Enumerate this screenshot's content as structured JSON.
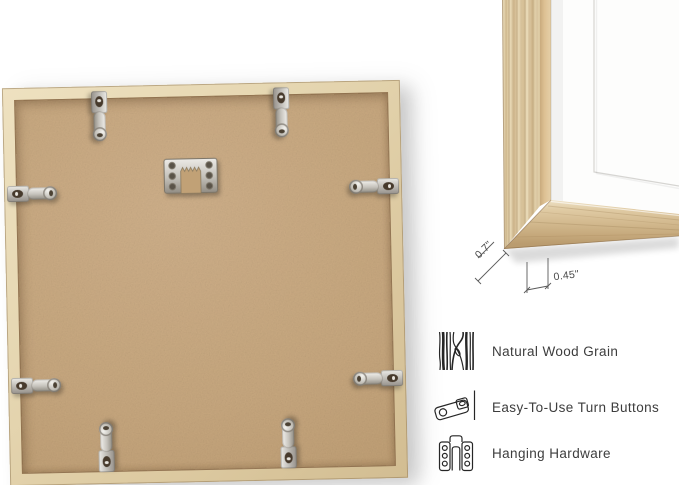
{
  "scene": {
    "description": "picture frame product views",
    "back_view": {
      "turn_button_count": 8,
      "hanger": "sawtooth-hanger"
    },
    "corner_detail": {
      "width_label": "0.7\"",
      "depth_label": "0.45\""
    }
  },
  "features": {
    "items": [
      {
        "icon": "wood-grain-icon",
        "label": "Natural Wood Grain"
      },
      {
        "icon": "turn-button-icon",
        "label": "Easy-To-Use Turn Buttons"
      },
      {
        "icon": "hanging-hardware-icon",
        "label": "Hanging Hardware"
      }
    ]
  },
  "colors": {
    "background": "#ffffff",
    "wood": "#dcc49c",
    "backing": "#c7a77e",
    "metal": "#c6c3bc",
    "label_text": "#3d3d3d",
    "dimension_lines": "#5a5a5a"
  }
}
